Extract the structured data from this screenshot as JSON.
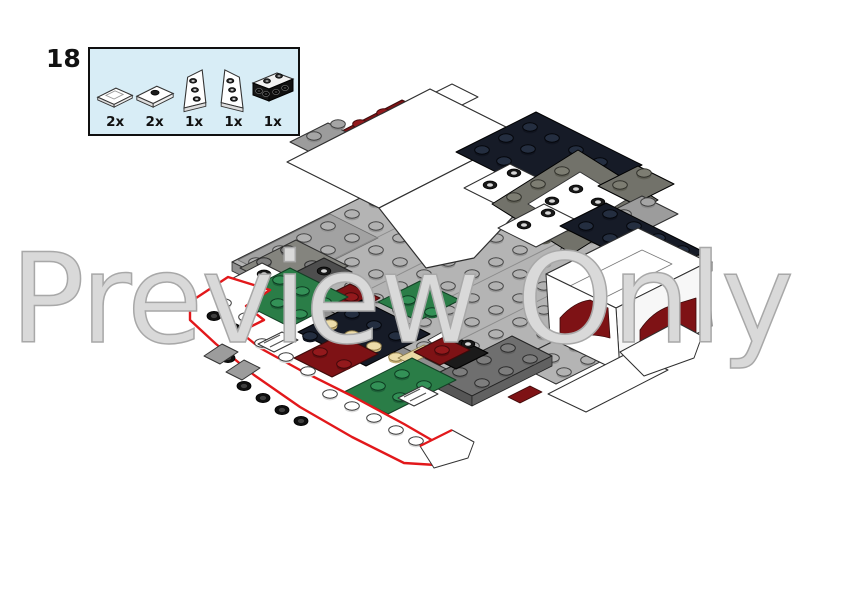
{
  "step": {
    "number": "18"
  },
  "parts_callout": {
    "parts": [
      {
        "name": "tile-1x2-white",
        "count": "2x"
      },
      {
        "name": "jumper-plate-1x2-white",
        "count": "2x"
      },
      {
        "name": "wedge-plate-left-white",
        "count": "1x"
      },
      {
        "name": "wedge-plate-right-white",
        "count": "1x"
      },
      {
        "name": "bracket-1x4-dark",
        "count": "1x"
      }
    ]
  },
  "watermark": {
    "text": "Preview Only"
  },
  "illustration": {
    "description": "Isometric LEGO building-step render: gray studded deck with white wedge plates, dark navy and olive plates, green, dark-red and tan accents; newly added white hull section at lower left outlined in red.",
    "new_parts_highlight_color": "#e2181b"
  },
  "palette": {
    "background": "#ffffff",
    "callout_fill": "#d8edf6",
    "callout_border": "#101010",
    "watermark_stroke": "#a8a8a8",
    "new_part_outline": "#e2181b",
    "plate_light_gray": "#b4b4b4",
    "plate_mid_gray": "#9c9c9c",
    "plate_dark_gray": "#6f6f6f",
    "plate_olive_gray": "#72726a",
    "plate_white": "#ffffff",
    "plate_navy": "#161b27",
    "plate_dark_red": "#7e1215",
    "plate_green": "#2a7d47",
    "stud_tan": "#ead9a4",
    "outline_dark": "#2f2f2f"
  }
}
